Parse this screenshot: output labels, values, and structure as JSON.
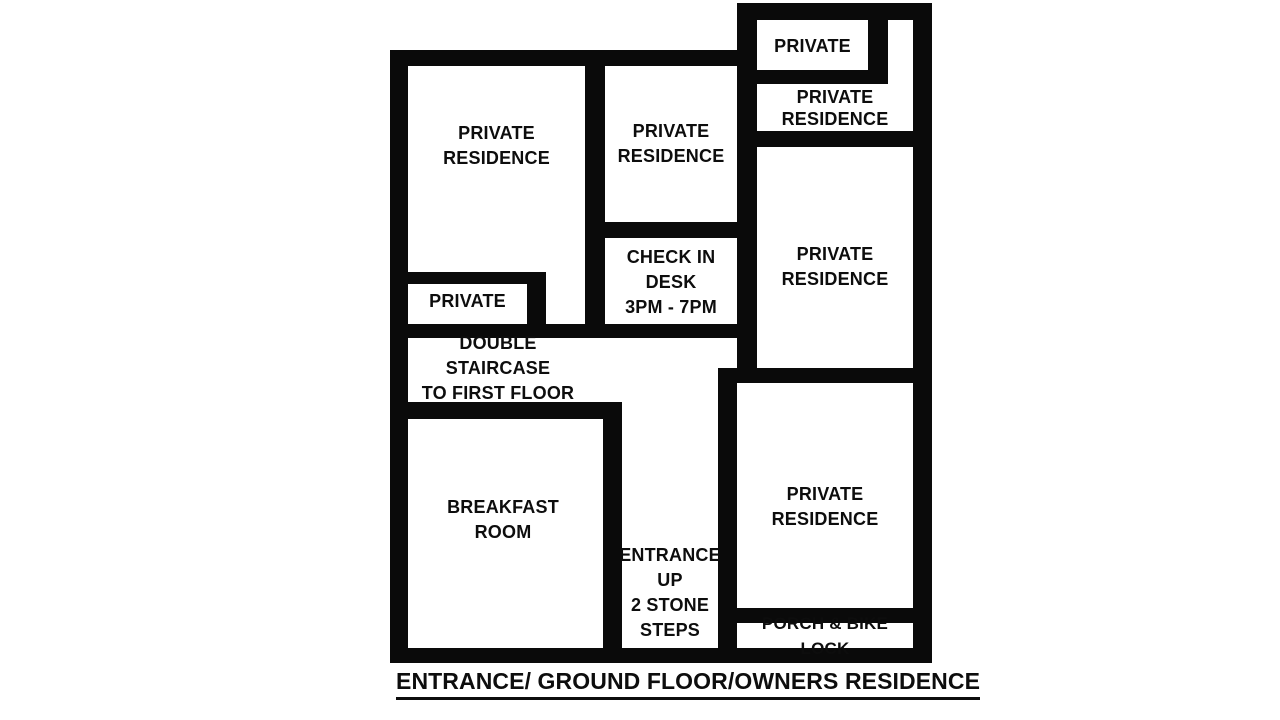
{
  "diagram": {
    "type": "hotel-floor-plan",
    "title": "ENTRANCE/ GROUND FLOOR/OWNERS RESIDENCE",
    "colors": {
      "wall": "#0a0a0a",
      "background": "#ffffff",
      "text": "#0d0d0d"
    },
    "rooms": {
      "top_left_residence": {
        "label": "PRIVATE\nRESIDENCE"
      },
      "middle_residence": {
        "label": "PRIVATE\nRESIDENCE"
      },
      "check_in_desk": {
        "label": "CHECK IN\nDESK\n3PM - 7PM"
      },
      "private_top_right": {
        "label": "PRIVATE"
      },
      "top_right_residence": {
        "label": "PRIVATE\nRESIDENCE"
      },
      "right_residence": {
        "label": "PRIVATE\nRESIDENCE"
      },
      "private_left": {
        "label": "PRIVATE"
      },
      "double_staircase": {
        "label": "DOUBLE STAIRCASE\nTO FIRST FLOOR"
      },
      "breakfast_room": {
        "label": "BREAKFAST\nROOM"
      },
      "entrance": {
        "label": "ENTRANCE\nUP\n2 STONE\nSTEPS"
      },
      "bottom_right_residence": {
        "label": "PRIVATE\nRESIDENCE"
      },
      "porch": {
        "label": "PORCH & BIKE LOCK"
      }
    }
  }
}
